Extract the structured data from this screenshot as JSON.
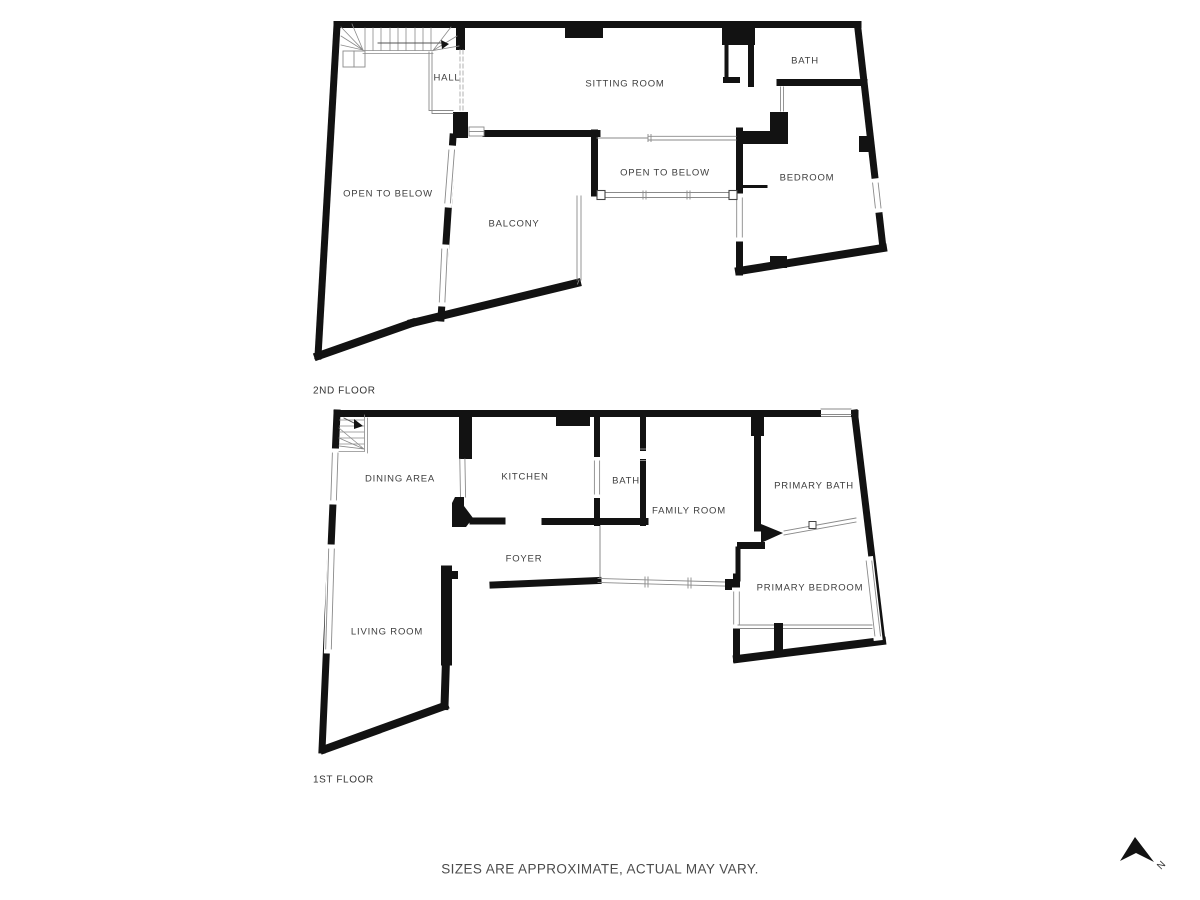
{
  "colors": {
    "wall": "#121212",
    "thin_line": "#8a8a8a",
    "label_text": "#3e3e3e",
    "footer_text": "#4b4b4b",
    "background": "#ffffff"
  },
  "floors": [
    {
      "name": "2ND FLOOR",
      "rooms": [
        {
          "label": "HALL"
        },
        {
          "label": "SITTING ROOM"
        },
        {
          "label": "BATH"
        },
        {
          "label": "OPEN TO BELOW"
        },
        {
          "label": "BALCONY"
        },
        {
          "label": "OPEN TO BELOW"
        },
        {
          "label": "BEDROOM"
        }
      ]
    },
    {
      "name": "1ST FLOOR",
      "rooms": [
        {
          "label": "DINING AREA"
        },
        {
          "label": "KITCHEN"
        },
        {
          "label": "BATH"
        },
        {
          "label": "FAMILY ROOM"
        },
        {
          "label": "PRIMARY BATH"
        },
        {
          "label": "FOYER"
        },
        {
          "label": "PRIMARY BEDROOM"
        },
        {
          "label": "LIVING ROOM"
        }
      ]
    }
  ],
  "footer": {
    "disclaimer": "SIZES ARE APPROXIMATE, ACTUAL MAY VARY."
  },
  "compass": {
    "north_label": "N"
  }
}
